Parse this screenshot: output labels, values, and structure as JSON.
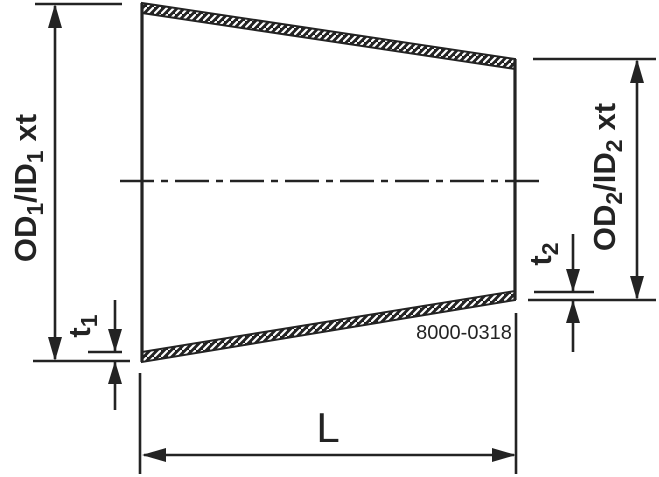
{
  "drawing": {
    "part_number": "8000-0318",
    "labels": {
      "od1": {
        "pre": "OD",
        "sub1": "1",
        "mid": "/ID",
        "sub2": "1",
        "post": "xt"
      },
      "od2": {
        "pre": "OD",
        "sub1": "2",
        "mid": "/ID",
        "sub2": "2",
        "post": "xt"
      },
      "t1": {
        "pre": "t",
        "sub": "1"
      },
      "t2": {
        "pre": "t",
        "sub": "2"
      },
      "length": "L"
    },
    "colors": {
      "line": "#232323",
      "background": "#ffffff"
    }
  }
}
